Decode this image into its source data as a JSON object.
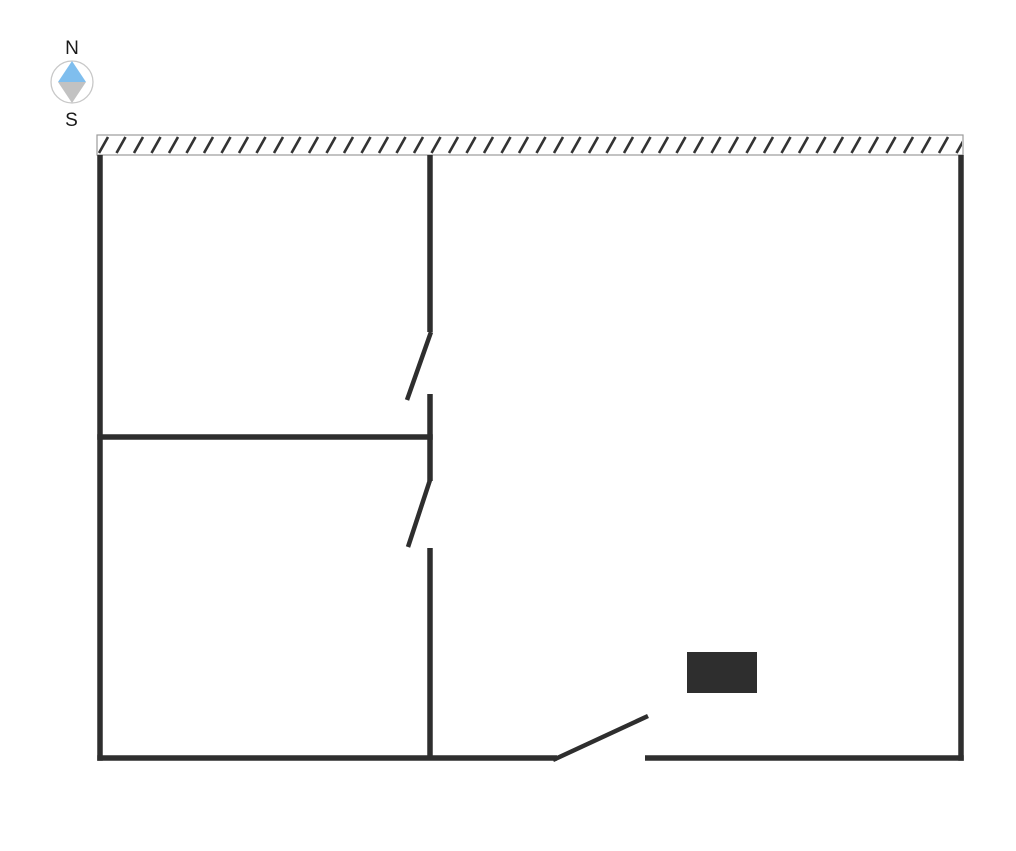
{
  "page": {
    "width": 1016,
    "height": 851,
    "background": "#ffffff"
  },
  "compass": {
    "north_label": "N",
    "south_label": "S",
    "cx": 72,
    "cy": 82,
    "radius": 21,
    "ring_color": "#c8c8c8",
    "needle_north_color": "#7fbeee",
    "needle_south_color": "#c2c2c2",
    "label_color": "#1a1a1a"
  },
  "floor_plan": {
    "wall_color": "#2e2e2e",
    "wall_thickness": 5.5,
    "door_leaf_thickness": 4.5,
    "hatched_wall": {
      "x": 97,
      "y": 135,
      "width": 866,
      "height": 20,
      "fill": "#ffffff",
      "border_color": "#9b9b9b",
      "hatch_color": "#333333",
      "hatch_spacing": 17.5,
      "hatch_run": 9,
      "hatch_thickness": 2.6
    },
    "walls": [
      {
        "name": "west-wall",
        "x1": 100,
        "y1": 155,
        "x2": 100,
        "y2": 760.75
      },
      {
        "name": "east-wall",
        "x1": 961,
        "y1": 155,
        "x2": 961,
        "y2": 760.75
      },
      {
        "name": "south-wall-west-segment",
        "x1": 97.25,
        "y1": 758,
        "x2": 557,
        "y2": 758
      },
      {
        "name": "south-wall-east-segment",
        "x1": 645,
        "y1": 758,
        "x2": 963.75,
        "y2": 758
      },
      {
        "name": "interior-wall-vertical-upper",
        "x1": 430,
        "y1": 155,
        "x2": 430,
        "y2": 332
      },
      {
        "name": "interior-wall-vertical-middle",
        "x1": 430,
        "y1": 394,
        "x2": 430,
        "y2": 481
      },
      {
        "name": "interior-wall-vertical-lower",
        "x1": 430,
        "y1": 548,
        "x2": 430,
        "y2": 758
      },
      {
        "name": "interior-wall-horizontal",
        "x1": 97.25,
        "y1": 437,
        "x2": 432.75,
        "y2": 437
      }
    ],
    "door_leaves": [
      {
        "name": "door-leaf-upper",
        "x1": 431,
        "y1": 332,
        "x2": 407,
        "y2": 400
      },
      {
        "name": "door-leaf-middle",
        "x1": 430,
        "y1": 480,
        "x2": 408,
        "y2": 547
      },
      {
        "name": "door-leaf-south",
        "x1": 553,
        "y1": 760,
        "x2": 648,
        "y2": 716
      }
    ],
    "furniture": {
      "x": 687,
      "y": 652,
      "width": 70,
      "height": 41,
      "color": "#2e2e2e"
    }
  }
}
